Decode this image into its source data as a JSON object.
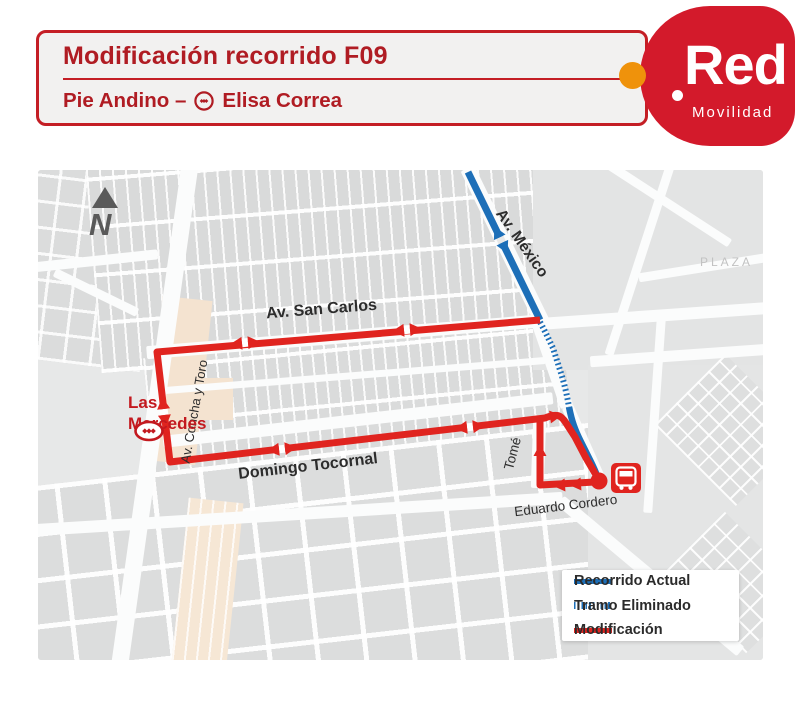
{
  "header": {
    "title": "Modificación recorrido F09",
    "subtitle_left": "Pie Andino –",
    "subtitle_right": "Elisa Correa"
  },
  "logo": {
    "brand": "Red",
    "tagline": "Movilidad"
  },
  "map": {
    "north": "N",
    "labels": {
      "av_mexico": "Av. México",
      "plaza": "PLAZA",
      "av_san_carlos": "Av. San Carlos",
      "av_concha_y_toro": "Av. Concha y Toro",
      "domingo_tocornal": "Domingo Tocornal",
      "tome": "Tomé",
      "eduardo_cordero": "Eduardo Cordero",
      "las_mercedes_line1": "Las",
      "las_mercedes_line2": "Mercedes"
    }
  },
  "legend": {
    "items": [
      {
        "label": "Recorrido Actual",
        "style": "solid",
        "color": "#1d6fb8"
      },
      {
        "label": "Tramo Eliminado",
        "style": "ticked",
        "color": "#1d6fb8"
      },
      {
        "label": "Modificación",
        "style": "solid",
        "color": "#e0241f"
      }
    ]
  },
  "colors": {
    "brand_red": "#d31a2b",
    "header_text_red": "#b01c23",
    "header_border_red": "#c41e25",
    "route_red": "#e0241f",
    "route_blue": "#1d6fb8",
    "accent_orange": "#ef920b",
    "map_background": "#e7e8e8"
  }
}
